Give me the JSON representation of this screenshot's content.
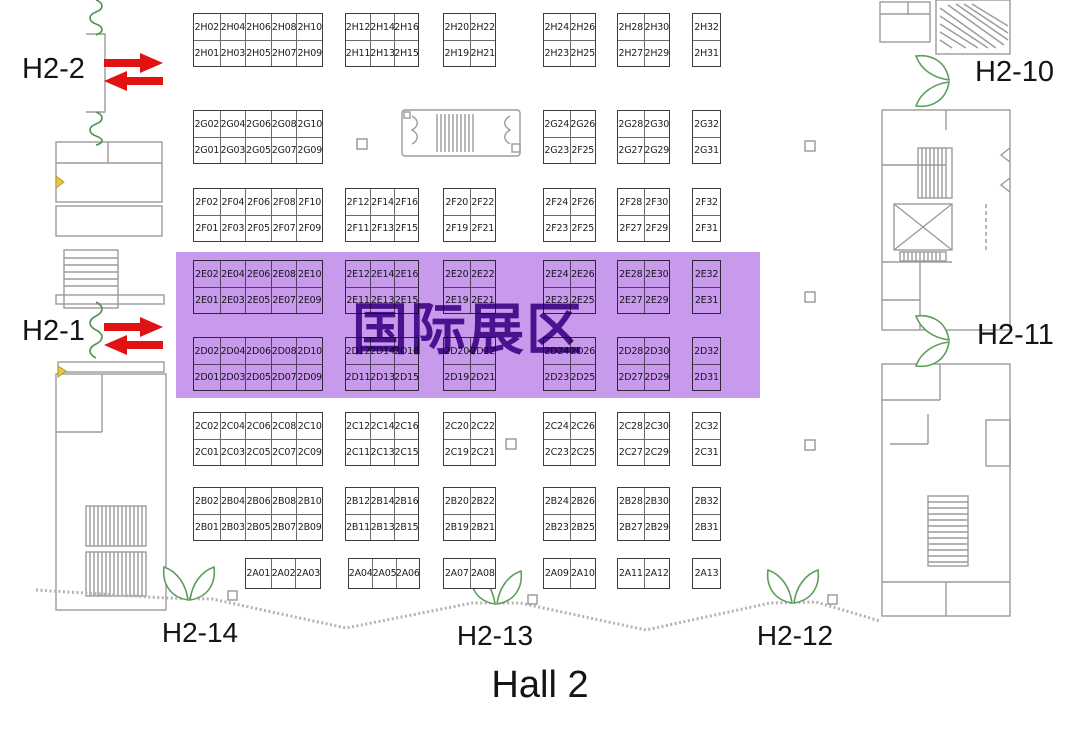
{
  "title": "Hall 2",
  "highlight": {
    "label": "国际展区",
    "bg": "#c89aec",
    "text_color": "#4a128e"
  },
  "colors": {
    "arrow_red": "#e11212",
    "door_green": "#5d9e5d",
    "wall_gray": "#9b9b9b",
    "boundary_gray": "#b3b3b3"
  },
  "icons": {
    "entrance_arrows": "double-red-arrows",
    "door_symbol": "double-swing-door",
    "flexible_wall": "green-squiggle-wall"
  },
  "gates": {
    "left": [
      {
        "label": "H2-2"
      },
      {
        "label": "H2-1"
      }
    ],
    "right": [
      {
        "label": "H2-10"
      },
      {
        "label": "H2-11"
      }
    ],
    "bottom": [
      {
        "label": "H2-14"
      },
      {
        "label": "H2-13"
      },
      {
        "label": "H2-12"
      }
    ]
  },
  "booth_rows": [
    {
      "row": "H",
      "blocks": [
        {
          "slot": 0,
          "top": [
            "2H02",
            "2H04",
            "2H06",
            "2H08",
            "2H10"
          ],
          "bottom": [
            "2H01",
            "2H03",
            "2H05",
            "2H07",
            "2H09"
          ]
        },
        {
          "slot": 1,
          "top": [
            "2H12",
            "2H14",
            "2H16"
          ],
          "bottom": [
            "2H11",
            "2H13",
            "2H15"
          ]
        },
        {
          "slot": 2,
          "top": [
            "2H20",
            "2H22"
          ],
          "bottom": [
            "2H19",
            "2H21"
          ]
        },
        {
          "slot": 3,
          "top": [
            "2H24",
            "2H26"
          ],
          "bottom": [
            "2H23",
            "2H25"
          ]
        },
        {
          "slot": 4,
          "top": [
            "2H28",
            "2H30"
          ],
          "bottom": [
            "2H27",
            "2H29"
          ]
        },
        {
          "slot": 5,
          "top": [
            "2H32"
          ],
          "bottom": [
            "2H31"
          ]
        }
      ]
    },
    {
      "row": "G",
      "blocks": [
        {
          "slot": 0,
          "top": [
            "2G02",
            "2G04",
            "2G06",
            "2G08",
            "2G10"
          ],
          "bottom": [
            "2G01",
            "2G03",
            "2G05",
            "2G07",
            "2G09"
          ]
        },
        {
          "slot": 3,
          "top": [
            "2G24",
            "2G26"
          ],
          "bottom": [
            "2G23",
            "2F25"
          ]
        },
        {
          "slot": 4,
          "top": [
            "2G28",
            "2G30"
          ],
          "bottom": [
            "2G27",
            "2G29"
          ]
        },
        {
          "slot": 5,
          "top": [
            "2G32"
          ],
          "bottom": [
            "2G31"
          ]
        }
      ]
    },
    {
      "row": "F",
      "blocks": [
        {
          "slot": 0,
          "top": [
            "2F02",
            "2F04",
            "2F06",
            "2F08",
            "2F10"
          ],
          "bottom": [
            "2F01",
            "2F03",
            "2F05",
            "2F07",
            "2F09"
          ]
        },
        {
          "slot": 1,
          "top": [
            "2F12",
            "2F14",
            "2F16"
          ],
          "bottom": [
            "2F11",
            "2F13",
            "2F15"
          ]
        },
        {
          "slot": 2,
          "top": [
            "2F20",
            "2F22"
          ],
          "bottom": [
            "2F19",
            "2F21"
          ]
        },
        {
          "slot": 3,
          "top": [
            "2F24",
            "2F26"
          ],
          "bottom": [
            "2F23",
            "2F25"
          ]
        },
        {
          "slot": 4,
          "top": [
            "2F28",
            "2F30"
          ],
          "bottom": [
            "2F27",
            "2F29"
          ]
        },
        {
          "slot": 5,
          "top": [
            "2F32"
          ],
          "bottom": [
            "2F31"
          ]
        }
      ]
    },
    {
      "row": "E",
      "blocks": [
        {
          "slot": 0,
          "top": [
            "2E02",
            "2E04",
            "2E06",
            "2E08",
            "2E10"
          ],
          "bottom": [
            "2E01",
            "2E03",
            "2E05",
            "2E07",
            "2E09"
          ]
        },
        {
          "slot": 1,
          "top": [
            "2E12",
            "2E14",
            "2E16"
          ],
          "bottom": [
            "2E11",
            "2E13",
            "2E15"
          ]
        },
        {
          "slot": 2,
          "top": [
            "2E20",
            "2E22"
          ],
          "bottom": [
            "2E19",
            "2E21"
          ]
        },
        {
          "slot": 3,
          "top": [
            "2E24",
            "2E26"
          ],
          "bottom": [
            "2E23",
            "2E25"
          ]
        },
        {
          "slot": 4,
          "top": [
            "2E28",
            "2E30"
          ],
          "bottom": [
            "2E27",
            "2E29"
          ]
        },
        {
          "slot": 5,
          "top": [
            "2E32"
          ],
          "bottom": [
            "2E31"
          ]
        }
      ]
    },
    {
      "row": "D",
      "blocks": [
        {
          "slot": 0,
          "top": [
            "2D02",
            "2D04",
            "2D06",
            "2D08",
            "2D10"
          ],
          "bottom": [
            "2D01",
            "2D03",
            "2D05",
            "2D07",
            "2D09"
          ]
        },
        {
          "slot": 1,
          "top": [
            "2D12",
            "2D14",
            "2D16"
          ],
          "bottom": [
            "2D11",
            "2D13",
            "2D15"
          ]
        },
        {
          "slot": 2,
          "top": [
            "2D20",
            "2D22"
          ],
          "bottom": [
            "2D19",
            "2D21"
          ]
        },
        {
          "slot": 3,
          "top": [
            "2D24",
            "2D26"
          ],
          "bottom": [
            "2D23",
            "2D25"
          ]
        },
        {
          "slot": 4,
          "top": [
            "2D28",
            "2D30"
          ],
          "bottom": [
            "2D27",
            "2D29"
          ]
        },
        {
          "slot": 5,
          "top": [
            "2D32"
          ],
          "bottom": [
            "2D31"
          ]
        }
      ]
    },
    {
      "row": "C",
      "blocks": [
        {
          "slot": 0,
          "top": [
            "2C02",
            "2C04",
            "2C06",
            "2C08",
            "2C10"
          ],
          "bottom": [
            "2C01",
            "2C03",
            "2C05",
            "2C07",
            "2C09"
          ]
        },
        {
          "slot": 1,
          "top": [
            "2C12",
            "2C14",
            "2C16"
          ],
          "bottom": [
            "2C11",
            "2C13",
            "2C15"
          ]
        },
        {
          "slot": 2,
          "top": [
            "2C20",
            "2C22"
          ],
          "bottom": [
            "2C19",
            "2C21"
          ]
        },
        {
          "slot": 3,
          "top": [
            "2C24",
            "2C26"
          ],
          "bottom": [
            "2C23",
            "2C25"
          ]
        },
        {
          "slot": 4,
          "top": [
            "2C28",
            "2C30"
          ],
          "bottom": [
            "2C27",
            "2C29"
          ]
        },
        {
          "slot": 5,
          "top": [
            "2C32"
          ],
          "bottom": [
            "2C31"
          ]
        }
      ]
    },
    {
      "row": "B",
      "blocks": [
        {
          "slot": 0,
          "top": [
            "2B02",
            "2B04",
            "2B06",
            "2B08",
            "2B10"
          ],
          "bottom": [
            "2B01",
            "2B03",
            "2B05",
            "2B07",
            "2B09"
          ]
        },
        {
          "slot": 1,
          "top": [
            "2B12",
            "2B14",
            "2B16"
          ],
          "bottom": [
            "2B11",
            "2B13",
            "2B15"
          ]
        },
        {
          "slot": 2,
          "top": [
            "2B20",
            "2B22"
          ],
          "bottom": [
            "2B19",
            "2B21"
          ]
        },
        {
          "slot": 3,
          "top": [
            "2B24",
            "2B26"
          ],
          "bottom": [
            "2B23",
            "2B25"
          ]
        },
        {
          "slot": 4,
          "top": [
            "2B28",
            "2B30"
          ],
          "bottom": [
            "2B27",
            "2B29"
          ]
        },
        {
          "slot": 5,
          "top": [
            "2B32"
          ],
          "bottom": [
            "2B31"
          ]
        }
      ]
    },
    {
      "row": "A",
      "single": true,
      "blocks": [
        {
          "slot": 0,
          "top": [
            "2A01",
            "2A02",
            "2A03"
          ]
        },
        {
          "slot": 1,
          "top": [
            "2A04",
            "2A05",
            "2A06"
          ]
        },
        {
          "slot": 2,
          "top": [
            "2A07",
            "2A08"
          ]
        },
        {
          "slot": 3,
          "top": [
            "2A09",
            "2A10"
          ]
        },
        {
          "slot": 4,
          "top": [
            "2A11",
            "2A12"
          ]
        },
        {
          "slot": 5,
          "top": [
            "2A13"
          ]
        }
      ]
    }
  ]
}
